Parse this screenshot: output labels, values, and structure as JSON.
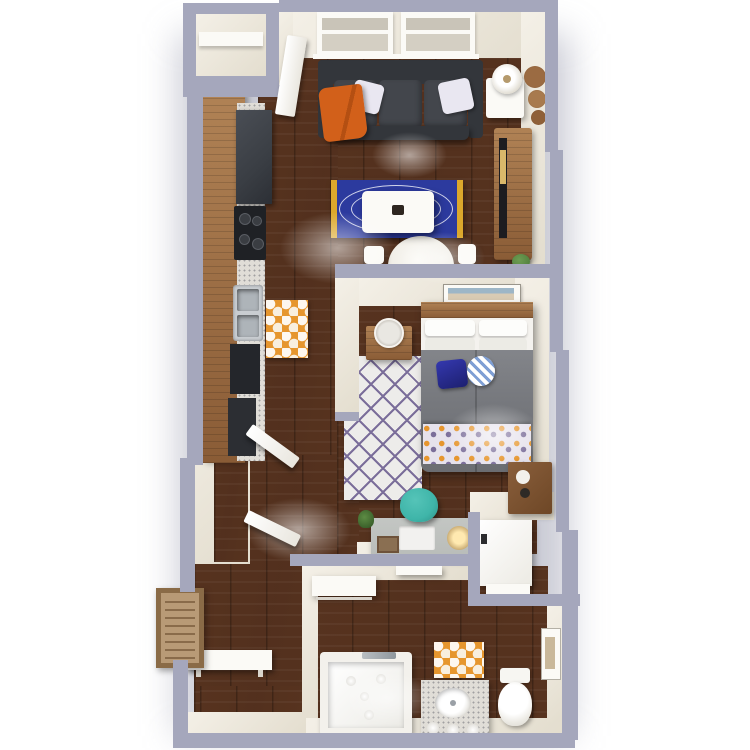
{
  "meta": {
    "title": "3D one-bedroom apartment floor plan render, top-down view",
    "view": "top-down isometric render",
    "background": "#ffffff"
  },
  "colors": {
    "wall": "#a5a7bc",
    "wallshadow": "#8f92a9",
    "cream": "#f4f0e7",
    "cream2": "#e3ddce",
    "white": "#fbfaf6",
    "floor1": "#57331f",
    "floor2": "#41251733",
    "bluerug": "#2c3a9e",
    "rugyellow": "#dca82c",
    "chevbg": "#edeceA",
    "chev": "#7b6e9a",
    "orange": "#e6962e",
    "sofa": "#43464c",
    "sofadark": "#33363b",
    "bed": "#77797e",
    "teal": "#3fb5a9",
    "wood": "#b08255",
    "wood2": "#8a5c36",
    "marble": "#e0ddd7",
    "desk": "#b9bcb9",
    "appliance": "#3a3e44",
    "stove": "#1f2125",
    "steel": "#c9cdd1",
    "green": "#4c7a3a",
    "throworange": "#d2601a",
    "artblue": "#9db6c7",
    "artsand": "#d9cbb4",
    "doormat": "#b89a76",
    "doormatedge": "#8a6b47"
  },
  "rooms": [
    {
      "name": "living-room"
    },
    {
      "name": "kitchen"
    },
    {
      "name": "bedroom"
    },
    {
      "name": "bathroom"
    },
    {
      "name": "hallway-entry"
    },
    {
      "name": "closets"
    }
  ],
  "furniture": {
    "living_room": [
      "double-window",
      "sofa",
      "throw-pillow-left",
      "throw-pillow-right",
      "orange-throw-blanket",
      "floor-lamp",
      "side-table",
      "wood-slice-wall-decor",
      "tv-console",
      "tv",
      "blue-oval-rug",
      "coffee-table",
      "round-dining-table",
      "dining-chairs",
      "potted-plant"
    ],
    "kitchen": [
      "wood-countertop",
      "refrigerator",
      "range-stove",
      "double-basin-sink",
      "marble-counter",
      "orange-pattern-mat",
      "lower-cabinets"
    ],
    "bedroom": [
      "bed",
      "wood-headboard",
      "white-pillows",
      "gray-duvet",
      "patterned-throw-blanket",
      "blue-accent-pillow",
      "round-basket",
      "nightstand",
      "round-mirror",
      "wall-art",
      "chevron-rug",
      "blanket-ladder",
      "wood-dresser",
      "desk",
      "laptop",
      "desk-lamp",
      "desk-plant",
      "picture-frame",
      "teal-desk-chair"
    ],
    "bathroom": [
      "bathtub",
      "marble-vanity-sink",
      "toilet",
      "orange-bath-mat",
      "wall-art-small",
      "washer-unit",
      "linen-closet-shelf",
      "towel-shelf"
    ],
    "hallway_entry": [
      "entry-bench",
      "entry-door-mat",
      "upper-hall-closet",
      "lower-hall-closet",
      "top-left-closet-shelf",
      "open-door-living",
      "open-door-hall-upper",
      "open-door-hall-lower"
    ]
  }
}
